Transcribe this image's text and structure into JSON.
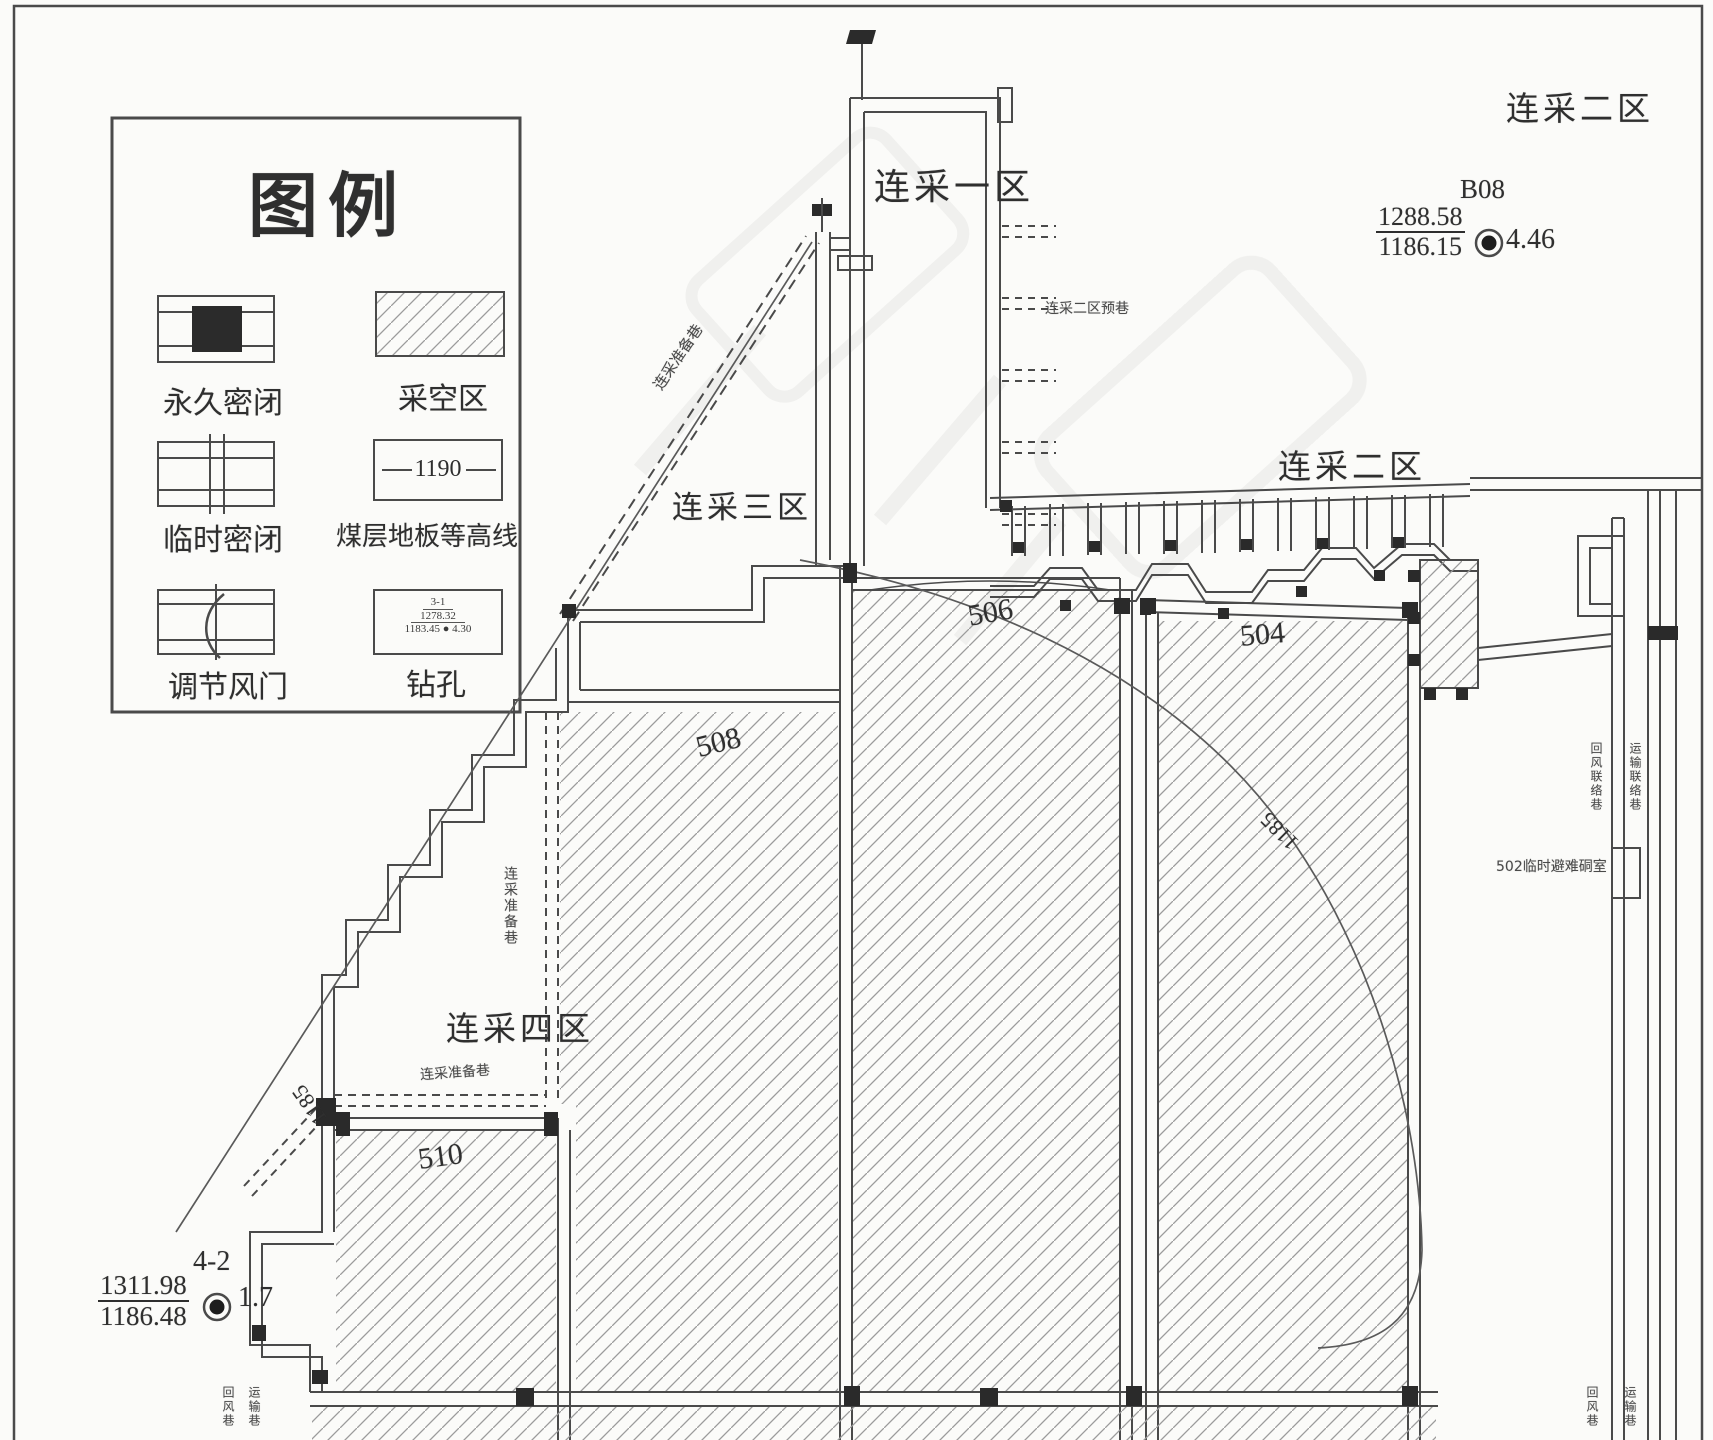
{
  "legend": {
    "title": "图例",
    "contour_value": "1190",
    "borehole_symbol": {
      "name": "3-1",
      "elev_top": "1278.32",
      "elev_bottom": "1183.45",
      "value": "4.30"
    },
    "items": [
      {
        "label": "永久密闭"
      },
      {
        "label": "采空区"
      },
      {
        "label": "临时密闭"
      },
      {
        "label": "煤层地板等高线"
      },
      {
        "label": "调节风门"
      },
      {
        "label": "钻孔"
      }
    ]
  },
  "zones": {
    "lc1": "连采一区",
    "lc2_corner": "连采二区",
    "lc2_mid": "连采二区",
    "lc3": "连采三区",
    "lc4": "连采四区"
  },
  "panels": {
    "p504": "504",
    "p506": "506",
    "p508": "508",
    "p510": "510"
  },
  "boreholes": {
    "b08": {
      "name": "B08",
      "elev_top": "1288.58",
      "elev_bottom": "1186.15",
      "value": "4.46"
    },
    "b42": {
      "name": "4-2",
      "elev_top": "1311.98",
      "elev_bottom": "1186.48",
      "value": "1.7"
    }
  },
  "annotations": {
    "lc2_branch": "连采二区预巷",
    "refuge": "502临时避难硐室",
    "prep_road_1": "连采准备巷",
    "prep_road_2": "连采准备巷",
    "prep_road_3": "连采准备巷",
    "contour_left": "1185",
    "contour_right": "1185",
    "strip_mid_1": "回风联络巷",
    "strip_mid_2": "运输联络巷",
    "strip_bl_1": "回风巷",
    "strip_bl_2": "运输巷",
    "strip_br_1": "回风巷",
    "strip_br_2": "运输巷"
  }
}
